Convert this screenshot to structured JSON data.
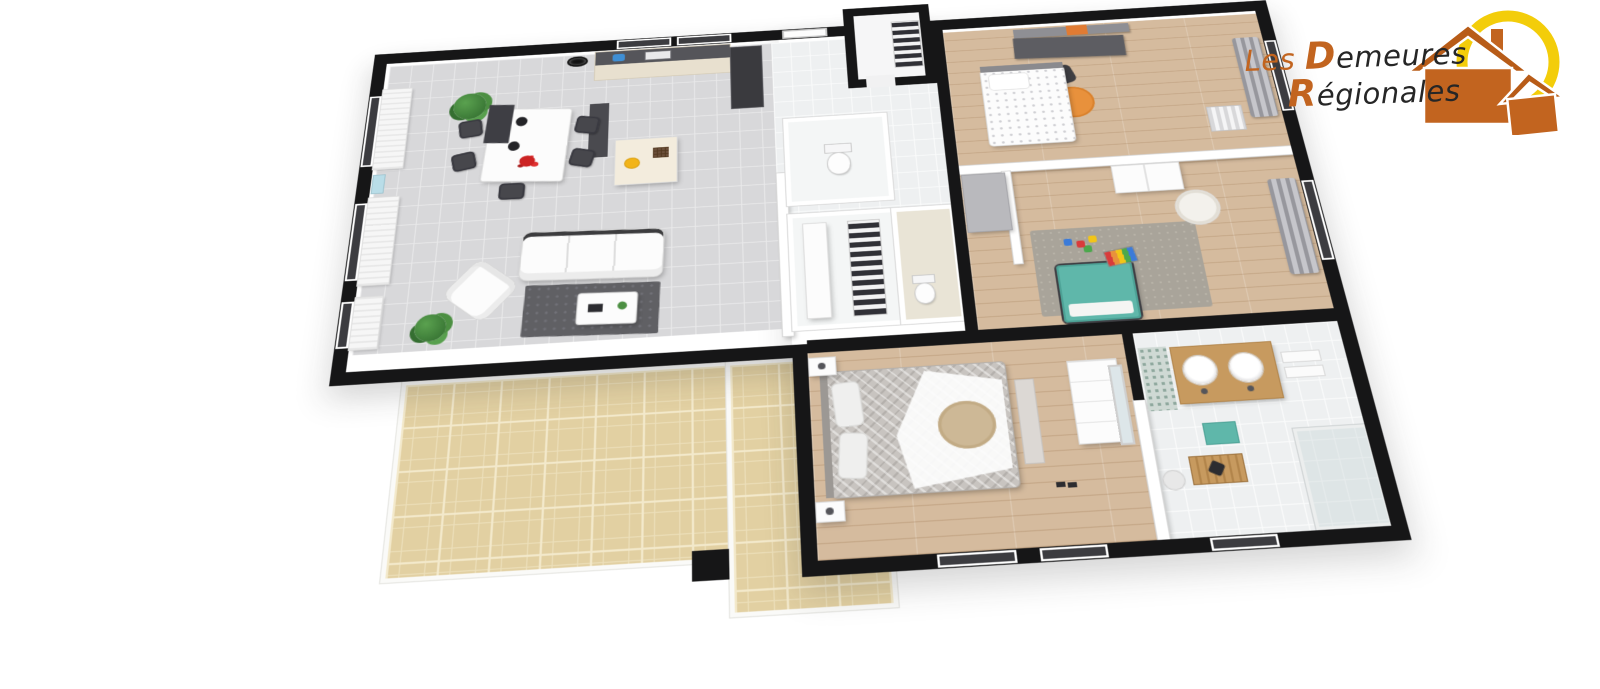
{
  "logo": {
    "name": "Les Demeures Régionales",
    "line1_prefix": "Les ",
    "line1_cap": "D",
    "line1_rest": "emeures",
    "line2_cap": "R",
    "line2_rest": "égionales",
    "text_color": "#262626",
    "accent_orange": "#c2641f",
    "ring_yellow": "#f3cd0a"
  },
  "palette": {
    "outer_wall_black": "#161617",
    "living_tile_gray": "#d8d8da",
    "hall_tile_white": "#eef0f1",
    "wood_floor": "#d5bb9e",
    "terrace_beige": "#e2d0a2",
    "kid_bed_teal": "#5fb7aa",
    "rug_orange": "#e8913c",
    "dark_rug_gray": "#606064",
    "plant_green": "#4c8f42",
    "flower_red": "#cc2323",
    "bowl_yellow": "#f2b419",
    "vanity_wood": "#c79a5f"
  },
  "floorplan": {
    "view": "3d-perspective-top-down",
    "rooms": [
      {
        "name": "living-dining-kitchen",
        "floor": "gray-tile"
      },
      {
        "name": "entry-hall",
        "floor": "white-tile"
      },
      {
        "name": "entry-closet",
        "floor": "white-tile"
      },
      {
        "name": "wc",
        "floor": "white-tile"
      },
      {
        "name": "walk-in-closet",
        "floor": "white-tile"
      },
      {
        "name": "shower-room",
        "floor": "beige-tile"
      },
      {
        "name": "hallway",
        "floor": "wood"
      },
      {
        "name": "bedroom-1",
        "floor": "wood"
      },
      {
        "name": "bedroom-2-kids",
        "floor": "wood"
      },
      {
        "name": "master-bedroom",
        "floor": "wood"
      },
      {
        "name": "bathroom",
        "floor": "white-tile"
      },
      {
        "name": "terrace",
        "floor": "beige-stone"
      }
    ],
    "furniture": [
      "sofa",
      "dining-table",
      "dining-chairs",
      "kitchen-counter",
      "kitchen-island",
      "fridge",
      "plants",
      "coffee-table",
      "armchair",
      "dark-rug",
      "double-bed-master",
      "single-bed",
      "kids-teal-bed",
      "desk",
      "orange-rug",
      "wardrobe",
      "toilet",
      "clothes-rack",
      "vanity-two-sinks",
      "shower",
      "towels",
      "toys"
    ]
  }
}
